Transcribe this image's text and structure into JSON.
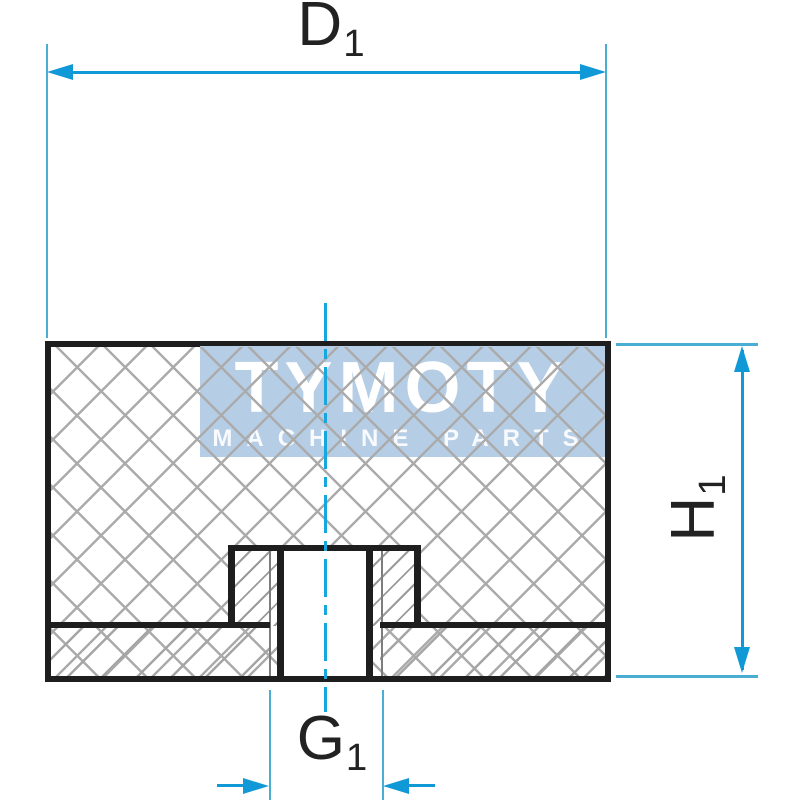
{
  "drawing": {
    "description": "Rubber-metal buffer cross-section drawing",
    "labels": {
      "d1": {
        "base": "D",
        "sub": "1"
      },
      "h1": {
        "base": "H",
        "sub": "1"
      },
      "g1": {
        "base": "G",
        "sub": "1"
      }
    },
    "watermark": {
      "title": "TYMOTY",
      "tagline": "MACHINE PARTS"
    },
    "colors": {
      "outline_black": "#1e1e1e",
      "hatch_gray": "#ababab",
      "dimension_blue": "#1099d6",
      "extension_blue": "#49aed2",
      "centerline_blue": "#18a6de",
      "watermark_band": "#b5cde5",
      "watermark_text": "#ffffff"
    }
  }
}
